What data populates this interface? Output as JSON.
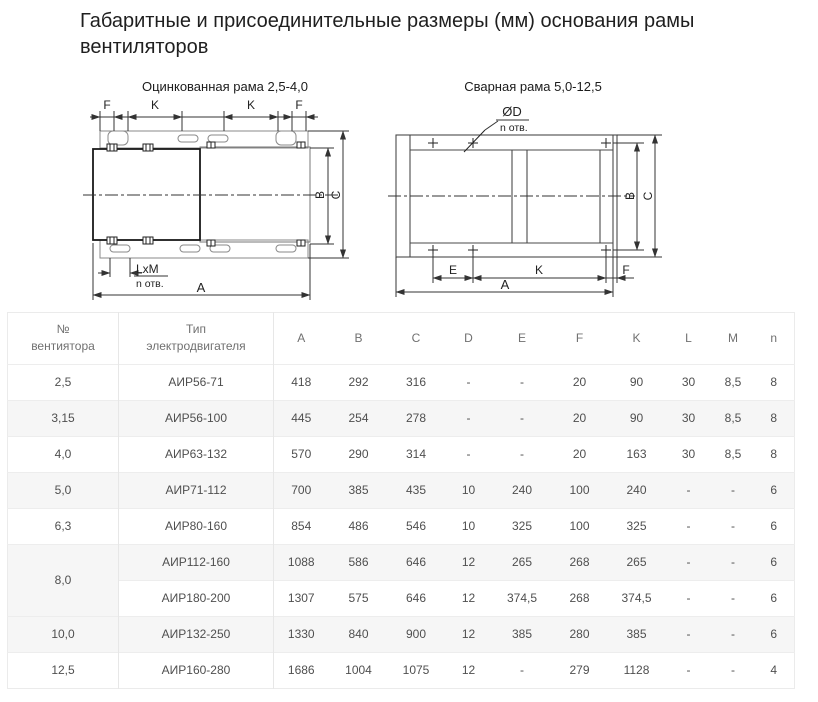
{
  "title": {
    "line1": "Габаритные и присоединительные размеры (мм) основания рамы",
    "line2": "вентиляторов"
  },
  "drawings": {
    "left": {
      "caption": "Оцинкованная рама 2,5-4,0",
      "labels": {
        "f1": "F",
        "k1": "K",
        "k2": "K",
        "f2": "F",
        "b": "B",
        "c": "C",
        "lxm": "LxM",
        "n_otv": "n отв.",
        "a": "A"
      }
    },
    "right": {
      "caption": "Сварная рама 5,0-12,5",
      "labels": {
        "od": "ØD",
        "n_otv": "n отв.",
        "e": "E",
        "k": "K",
        "f": "F",
        "a": "A",
        "b": "B",
        "c": "C"
      }
    }
  },
  "table": {
    "headers": [
      {
        "top": "№",
        "bottom": "вентиятора"
      },
      {
        "top": "Тип",
        "bottom": "электродвигателя"
      },
      {
        "top": "A"
      },
      {
        "top": "B"
      },
      {
        "top": "C"
      },
      {
        "top": "D"
      },
      {
        "top": "E"
      },
      {
        "top": "F"
      },
      {
        "top": "K"
      },
      {
        "top": "L"
      },
      {
        "top": "M"
      },
      {
        "top": "n"
      }
    ],
    "rows": [
      {
        "no": "2,5",
        "rowspan": 1,
        "cells": [
          "АИР56-71",
          "418",
          "292",
          "316",
          "-",
          "-",
          "20",
          "90",
          "30",
          "8,5",
          "8"
        ]
      },
      {
        "no": "3,15",
        "rowspan": 1,
        "cells": [
          "АИР56-100",
          "445",
          "254",
          "278",
          "-",
          "-",
          "20",
          "90",
          "30",
          "8,5",
          "8"
        ]
      },
      {
        "no": "4,0",
        "rowspan": 1,
        "cells": [
          "АИР63-132",
          "570",
          "290",
          "314",
          "-",
          "-",
          "20",
          "163",
          "30",
          "8,5",
          "8"
        ]
      },
      {
        "no": "5,0",
        "rowspan": 1,
        "cells": [
          "АИР71-112",
          "700",
          "385",
          "435",
          "10",
          "240",
          "100",
          "240",
          "-",
          "-",
          "6"
        ]
      },
      {
        "no": "6,3",
        "rowspan": 1,
        "cells": [
          "АИР80-160",
          "854",
          "486",
          "546",
          "10",
          "325",
          "100",
          "325",
          "-",
          "-",
          "6"
        ]
      },
      {
        "no": "8,0",
        "rowspan": 2,
        "cells": [
          "АИР112-160",
          "1088",
          "586",
          "646",
          "12",
          "265",
          "268",
          "265",
          "-",
          "-",
          "6"
        ]
      },
      {
        "no": null,
        "cells": [
          "АИР180-200",
          "1307",
          "575",
          "646",
          "12",
          "374,5",
          "268",
          "374,5",
          "-",
          "-",
          "6"
        ]
      },
      {
        "no": "10,0",
        "rowspan": 1,
        "cells": [
          "АИР132-250",
          "1330",
          "840",
          "900",
          "12",
          "385",
          "280",
          "385",
          "-",
          "-",
          "6"
        ]
      },
      {
        "no": "12,5",
        "rowspan": 1,
        "cells": [
          "АИР160-280",
          "1686",
          "1004",
          "1075",
          "12",
          "-",
          "279",
          "1128",
          "-",
          "-",
          "4"
        ]
      }
    ]
  },
  "colors": {
    "title_text": "#1f1f1f",
    "table_text": "#4f4f4f",
    "header_text": "#707070",
    "stripe": "#f6f6f6",
    "border": "#ebebeb",
    "drawing_line": "#333333"
  }
}
